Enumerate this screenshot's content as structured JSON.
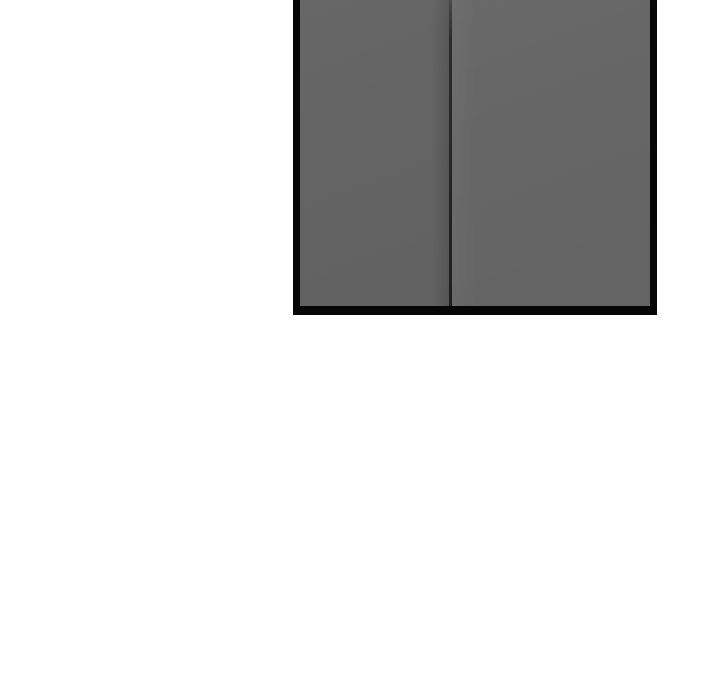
{
  "scene": {
    "object": "closed double doors with black frame, cropped at top of image"
  },
  "colors": {
    "page_bg": "#ffffff",
    "door_frame": "#060606",
    "door_panel_left": "#646464",
    "door_panel_right": "#666666",
    "door_gap": "#262626"
  }
}
